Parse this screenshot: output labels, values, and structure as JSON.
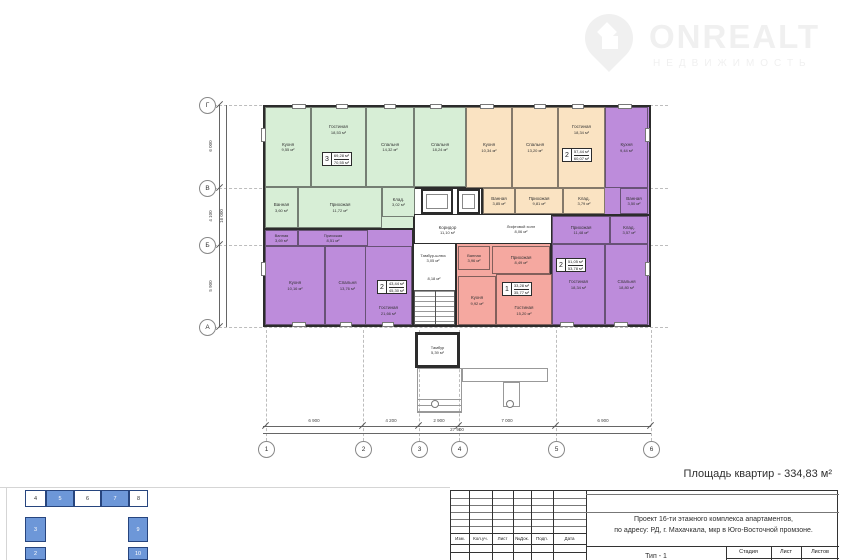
{
  "logo": {
    "title": "ONREALT",
    "subtitle": "НЕДВИЖИМОСТЬ"
  },
  "area_note": "Площадь квартир - 334,83 м²",
  "axes": {
    "cols": [
      "1",
      "2",
      "3",
      "4",
      "5",
      "6"
    ],
    "rows": [
      "Г",
      "В",
      "Б",
      "А"
    ]
  },
  "dims": {
    "bottom": [
      "6 900",
      "4 200",
      "2 900",
      "7 000",
      "6 900"
    ],
    "bottom_total": "27 900",
    "left": [
      "6 000",
      "4 100",
      "5 900"
    ],
    "left_total": "16 000"
  },
  "apartments": {
    "green": {
      "color": "#d7eed6",
      "stamp": {
        "num": "3",
        "area1": "69,28 м²",
        "area2": "70,55 м²"
      },
      "rooms": [
        {
          "name": "Кухня",
          "area": "9,55 м²"
        },
        {
          "name": "Гостиная",
          "area": "18,53 м²"
        },
        {
          "name": "Спальня",
          "area": "14,32 м²"
        },
        {
          "name": "Спальня",
          "area": "18,24 м²"
        },
        {
          "name": "Ванная",
          "area": "3,60 м²"
        },
        {
          "name": "Прихожая",
          "area": "11,72 м²"
        },
        {
          "name": "Клад.",
          "area": "3,02 м²"
        }
      ]
    },
    "orange": {
      "color": "#fae3c2",
      "stamp": {
        "num": "2",
        "area1": "57,44 м²",
        "area2": "60,07 м²"
      },
      "rooms": [
        {
          "name": "Кухня",
          "area": "10,34 м²"
        },
        {
          "name": "Спальня",
          "area": "13,20 м²"
        },
        {
          "name": "Гостиная",
          "area": "18,34 м²"
        },
        {
          "name": "Ванная",
          "area": "3,85 м²"
        },
        {
          "name": "Прихожая",
          "area": "9,81 м²"
        },
        {
          "name": "Клад.",
          "area": "3,79 м²"
        }
      ]
    },
    "purple_right": {
      "color": "#bd8cdb",
      "stamp": {
        "num": "2",
        "area1": "51,05 м²",
        "area2": "53,78 м²"
      },
      "rooms": [
        {
          "name": "Кухня",
          "area": "9,44 м²"
        },
        {
          "name": "Ванная",
          "area": "3,50 м²"
        },
        {
          "name": "Клад.",
          "area": "3,57 м²"
        },
        {
          "name": "Прихожая",
          "area": "11,48 м²"
        },
        {
          "name": "Гостиная",
          "area": "18,34 м²"
        },
        {
          "name": "Спальня",
          "area": "18,80 м²"
        }
      ]
    },
    "purple_left": {
      "color": "#bd8cdb",
      "stamp": {
        "num": "2",
        "area1": "43,44 м²",
        "area2": "45,30 м²"
      },
      "rooms": [
        {
          "name": "Ванная",
          "area": "3,69 м²"
        },
        {
          "name": "Прихожая",
          "area": "8,51 м²"
        },
        {
          "name": "Кухня",
          "area": "10,16 м²"
        },
        {
          "name": "Спальня",
          "area": "13,76 м²"
        },
        {
          "name": "Гостиная",
          "area": "21,66 м²"
        }
      ]
    },
    "pink": {
      "color": "#f5a8a0",
      "stamp": {
        "num": "1",
        "area1": "33,28 м²",
        "area2": "35,77 м²"
      },
      "rooms": [
        {
          "name": "Ванная",
          "area": "3,96 м²"
        },
        {
          "name": "Прихожая",
          "area": "8,49 м²"
        },
        {
          "name": "Кухня",
          "area": "9,92 м²"
        },
        {
          "name": "Гостиная",
          "area": "15,20 м²"
        }
      ]
    }
  },
  "common": {
    "rooms": [
      {
        "name": "Коридор",
        "area": "11,10 м²"
      },
      {
        "name": "Лифтовой холл",
        "area": "8,06 м²"
      },
      {
        "name": "Тамбур-шлюз",
        "area": "3,05 м²"
      },
      {
        "name": "",
        "area": "8,18 м²"
      },
      {
        "name": "Тамбур",
        "area": "5,39 м²"
      }
    ]
  },
  "titleblock": {
    "cols": [
      "Изм.",
      "Кол.уч.",
      "Лист",
      "№Док.",
      "Подп.",
      "Дата"
    ],
    "project_line1": "Проект 16-ти этажного комплекса апартаментов,",
    "project_line2": "по адресу: РД, г. Махачкала, мкр в Юго-Восточной промзоне.",
    "stage_cols": [
      "Стадия",
      "Лист",
      "Листов"
    ],
    "type_label": "Тип - 1"
  },
  "keyplan": {
    "blocks": [
      {
        "label": "4",
        "filled": false
      },
      {
        "label": "5",
        "filled": true
      },
      {
        "label": "6",
        "filled": false
      },
      {
        "label": "7",
        "filled": true
      },
      {
        "label": "8",
        "filled": false
      },
      {
        "label": "3",
        "filled": true
      },
      {
        "label": "9",
        "filled": true
      },
      {
        "label": "2",
        "filled": true
      },
      {
        "label": "10",
        "filled": true
      }
    ]
  },
  "colors": {
    "green": "#d7eed6",
    "orange": "#fae3c2",
    "purple": "#bd8cdb",
    "pink": "#f5a8a0",
    "keyplan_blue": "#6d97d8",
    "wall": "#2c2c2c"
  }
}
